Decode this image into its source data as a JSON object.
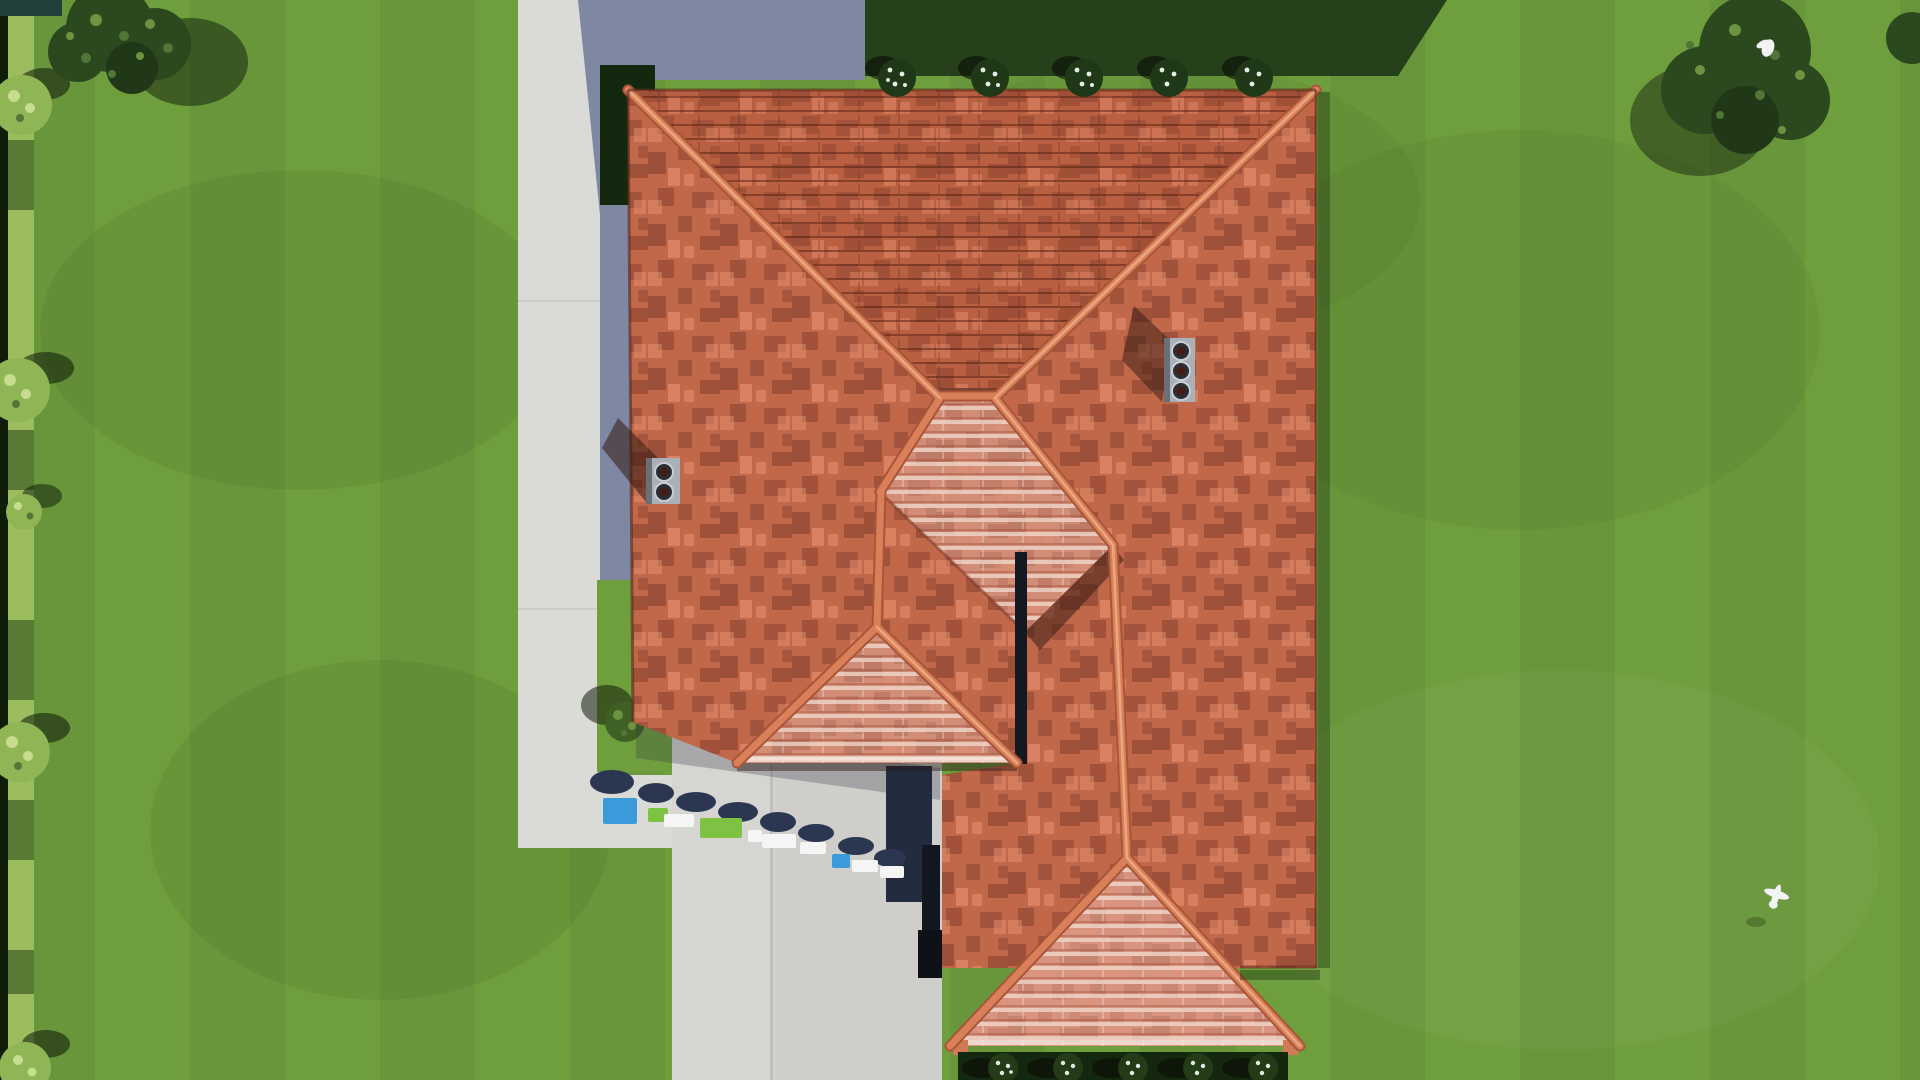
{
  "scene": {
    "description": "Top-down aerial 3D architectural rendering of a single house with a terracotta shingled hip roof, surrounded by a mown green lawn, a concrete walkway and driveway on the left/bottom, hedges along the left boundary, trees in the corners, flowering shrubs along the house, two chimneys, two white birds, and an illegible 3D watermark logo standing on the driveway",
    "counts": {
      "left_chimney_flues": 2,
      "right_chimney_flues": 3,
      "top_flower_bushes": 5,
      "porch_flower_bushes": 5,
      "hedge_round_bushes": 5,
      "birds": 2,
      "trees": 2
    },
    "watermark": {
      "legible": false,
      "block_colors": [
        "#3b9ad9",
        "#7dc242",
        "#f5f5f5",
        "#2b3650"
      ]
    }
  },
  "colors": {
    "lawn": "#6f9e3d",
    "lawnPatch": "#5f8c34",
    "shadowGrass": "#25401a",
    "shadowGrassDeep": "#14280f",
    "hedge": "#9cbd5e",
    "hedgeDark": "#4e6e2e",
    "hedgeEdge": "#101c0a",
    "treeCanopy": "#2b481f",
    "treeSpeckle": "#517637",
    "treeSpeckleLight": "#6d9340",
    "bushLight": "#8fb554",
    "bushSpeckle": "#c8dc8f",
    "path": "#dadad7",
    "pathShadow": "#7e88a3",
    "driveway": "#d6d5d2",
    "navyShadow": "#232c3f",
    "slitShadow": "#12161f",
    "roofBase": "#c1684a",
    "roofDark": "#8f4b36",
    "roofLight": "#d07a58",
    "roofNorth": "#b95f42",
    "roofSheen": "#d28d77",
    "sheenRow": "#f1ddd2",
    "porch": "#d89480",
    "ridge": "#d9805a",
    "ridgeDark": "#a85538",
    "ridgeHi": "#e8a87f",
    "chimney": "#aab0b8",
    "chimneyDark": "#6a7078",
    "flue": "#2a2e35",
    "flueInner": "#451d16",
    "flueRing": "#c9ced4",
    "flowerWhite": "#e8ece7",
    "bushDark": "#223c18",
    "birdWhite": "#f2f3f5",
    "wmBlue": "#3b9ad9",
    "wmGreen": "#7dc242",
    "wmWhite": "#f5f5f5",
    "wmShadow": "#2b3650"
  }
}
